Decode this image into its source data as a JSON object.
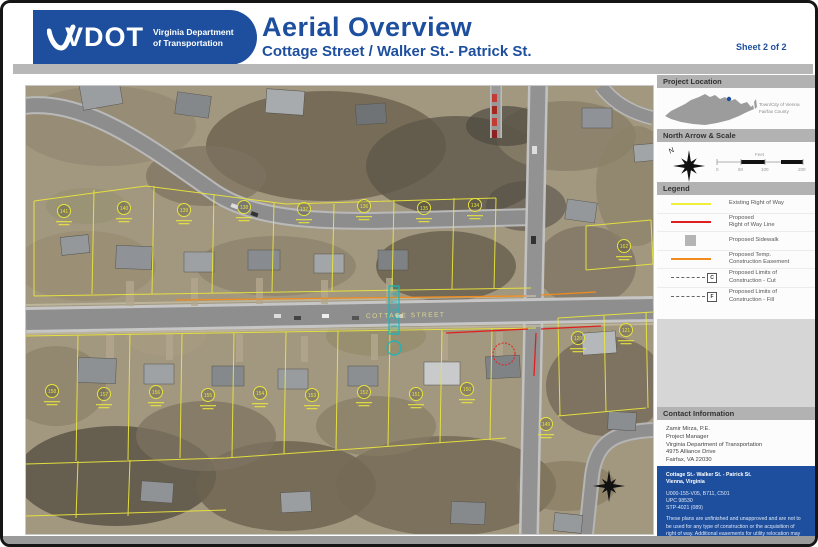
{
  "header": {
    "logo_acronym": "VDOT",
    "logo_agency_line1": "Virginia Department",
    "logo_agency_line2": "of Transportation",
    "title": "Aerial Overview",
    "subtitle": "Cottage Street / Walker St.- Patrick St.",
    "sheet_label": "Sheet 2 of 2"
  },
  "accent_colors": {
    "vdot_blue": "#1d4f9e",
    "panel_gray": "#b2b2b2",
    "legend_yellow": "#f2ef3a",
    "legend_red": "#e02020",
    "legend_orange": "#f08c1e"
  },
  "map": {
    "street_label": "COTTAGE STREET",
    "parcel_numbers_top": [
      "141",
      "140",
      "139",
      "138",
      "137",
      "136",
      "135",
      "134"
    ],
    "parcel_numbers_bottom": [
      "158",
      "157",
      "156",
      "155",
      "154",
      "153",
      "152",
      "151",
      "150"
    ],
    "parcel_numbers_extra": [
      "120",
      "121",
      "162",
      "149"
    ]
  },
  "sidebar": {
    "project_location": {
      "title": "Project Location",
      "note_line1": "Town/City of Vienna",
      "note_line2": "Fairfax County"
    },
    "north_arrow_scale": {
      "title": "North Arrow & Scale",
      "north_label": "N",
      "scale_unit": "Feet",
      "scale_ticks": [
        "0",
        "50",
        "100",
        "200"
      ]
    },
    "legend": {
      "title": "Legend",
      "items": [
        {
          "label1": "Existing Right of Way",
          "label2": ""
        },
        {
          "label1": "Proposed",
          "label2": "Right of Way Line"
        },
        {
          "label1": "Proposed Sidewalk",
          "label2": ""
        },
        {
          "label1": "Proposed Temp.",
          "label2": "Construction Easement"
        },
        {
          "label1": "Proposed Limits of",
          "label2": "Construction - Cut",
          "marker": "C"
        },
        {
          "label1": "Proposed Limits of",
          "label2": "Construction - Fill",
          "marker": "F"
        }
      ]
    },
    "contact": {
      "title": "Contact Information",
      "lines": [
        "Zamir Mirza, P.E.",
        "Project Manager",
        "Virginia Department of Transportation",
        "4975 Alliance Drive",
        "Fairfax, VA 22030"
      ],
      "comments_line1": "Comments may also be sent to:",
      "comments_line2": "Zamir.Mirza@VDOT.Virginia.gov",
      "project_box": {
        "name_line1": "Cottage St.- Walker St. - Patrick St.",
        "name_line2": "Vienna, Virginia",
        "ref_line1": "U000-155-V05, B711, C501",
        "ref_line2": "UPC 98530",
        "ref_line3": "STP-4021 (089)",
        "disclaimer": "These plans are unfinished and unapproved and are not to be used for any type of construction or the acquisition of right of way.  Additional easements for utility relocation may be required beyond the proposed right of way shown on these plans.",
        "credit": "Imagery Courtesy of the Commonwealth of Virginia copyright 2006/2015"
      }
    }
  }
}
